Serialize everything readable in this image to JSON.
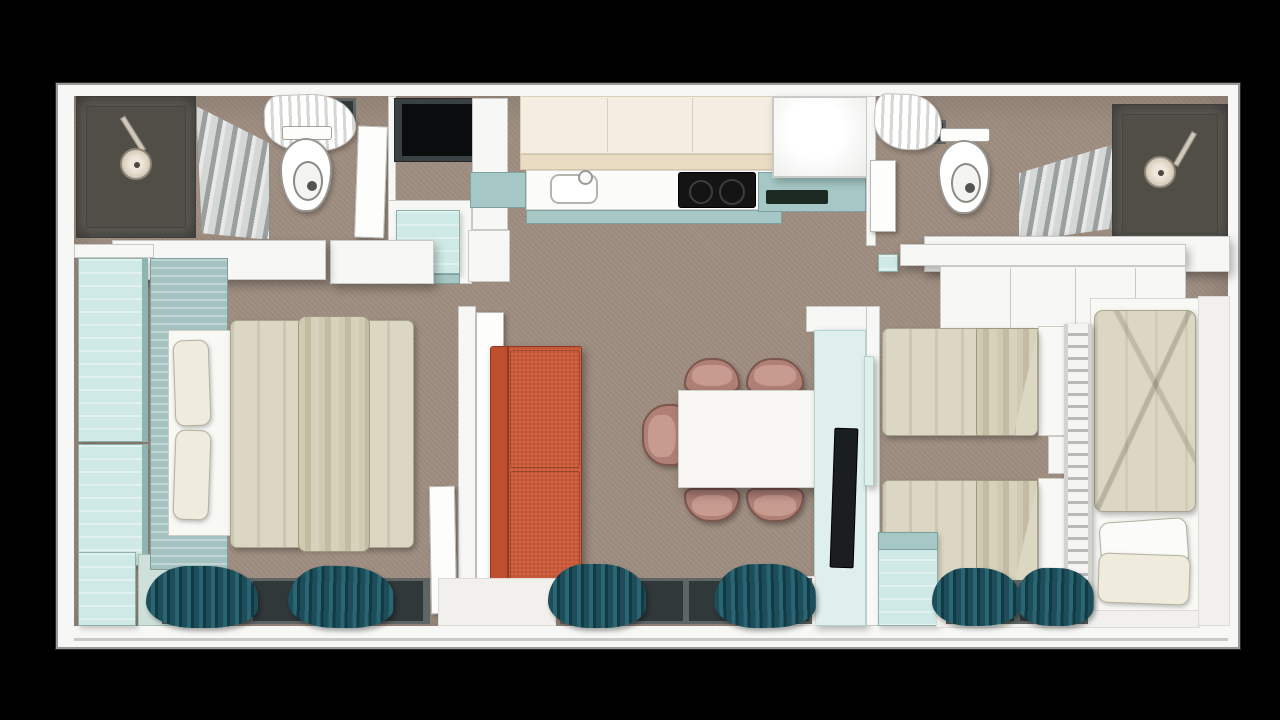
{
  "scene": {
    "title": "Top-down 3D rendered floor plan of a two-bedroom mobile home"
  },
  "palette": {
    "bg": "#000000",
    "floor": "#9e8d80",
    "wall": "#f7f7f5",
    "wall_line": "#c9c9c6",
    "outline": "#9a9a96",
    "shower_dark": "#5d5b55",
    "shower_floor": "#504e47",
    "showerhead": "#d7cbb8",
    "glass_light": "#d9dcdc",
    "glass_mid": "#9aa1a1",
    "teal_light": "#cfeae6",
    "teal_mid": "#a5c8c6",
    "teal_deep": "#8fb5b3",
    "headboard": "#a3c2c0",
    "cream_cab": "#f3eee1",
    "cream_edge": "#e9dcc3",
    "counter": "#fbfbfa",
    "hob": "#141414",
    "drainer": "#1c2a21",
    "sofa": "#cf5a38",
    "sofa_dark": "#bf4e2e",
    "chair_back": "#b08077",
    "chair_seat": "#c89b91",
    "table": "#f7f6f2",
    "tv_panel": "#dff0ec",
    "tv": "#1b1e21",
    "duvet": "#dcd7c3",
    "duvet_fold": "#cdc7ae",
    "sheet": "#f8f8f5",
    "pillow": "#efebdd",
    "curtain": "#235763",
    "curtain_dark": "#17424d",
    "window": "#30383a",
    "window_frame": "#5e6665",
    "doorway": "#0b0c0d",
    "doorway_frame": "#3a4144",
    "entry_floor": "#f1f0ec",
    "bench": "#cfe0da"
  },
  "rooms": [
    {
      "id": "bathroom-left",
      "name": "Bathroom 1 – shower and toilet"
    },
    {
      "id": "entry-hall",
      "name": "Entry hall with wardrobe"
    },
    {
      "id": "kitchen",
      "name": "Kitchen"
    },
    {
      "id": "bathroom-right",
      "name": "Bathroom 2 – shower and toilet"
    },
    {
      "id": "bedroom-master",
      "name": "Master bedroom with double bed"
    },
    {
      "id": "living-dining",
      "name": "Living / dining area"
    },
    {
      "id": "bedroom-twin",
      "name": "Twin bedroom with bunk"
    }
  ],
  "furniture": {
    "shower_left": {
      "label": "Walk-in shower"
    },
    "toilet_left": {
      "label": "Toilet"
    },
    "towel_left": {
      "label": "Towels on rail"
    },
    "entrance": {
      "label": "Entrance doorway"
    },
    "hall_wardrobe": {
      "label": "Hall cabinet with open shelf"
    },
    "upper_cabinets": {
      "label": "Kitchen upper cabinets"
    },
    "kitchen_sink": {
      "label": "Kitchen sink"
    },
    "hob": {
      "label": "Induction hob"
    },
    "fridge": {
      "label": "Tall cabinet / fridge"
    },
    "shower_right": {
      "label": "Walk-in shower"
    },
    "toilet_right": {
      "label": "Toilet"
    },
    "towel_right": {
      "label": "Towels on rail"
    },
    "wardrobe_master": {
      "label": "Wardrobe columns"
    },
    "double_bed": {
      "label": "Double bed with duvet and pillows"
    },
    "sofa": {
      "label": "Orange two-seat sofa"
    },
    "dining_table": {
      "label": "Dining table"
    },
    "dining_chairs": {
      "label": "Dining chairs",
      "count": 5
    },
    "tv_unit": {
      "label": "TV partition wall"
    },
    "twin_bed_top": {
      "label": "Single bed"
    },
    "twin_bed_bottom": {
      "label": "Single bed"
    },
    "nightstand": {
      "label": "Nightstand"
    },
    "bunk_bed": {
      "label": "Bed with ladder"
    },
    "ladder": {
      "label": "Bunk ladder"
    },
    "wardrobe_twin": {
      "label": "Bedroom cabinet"
    },
    "curtains": {
      "label": "Dark teal curtains"
    },
    "windows": {
      "label": "Floor-level windows"
    }
  }
}
